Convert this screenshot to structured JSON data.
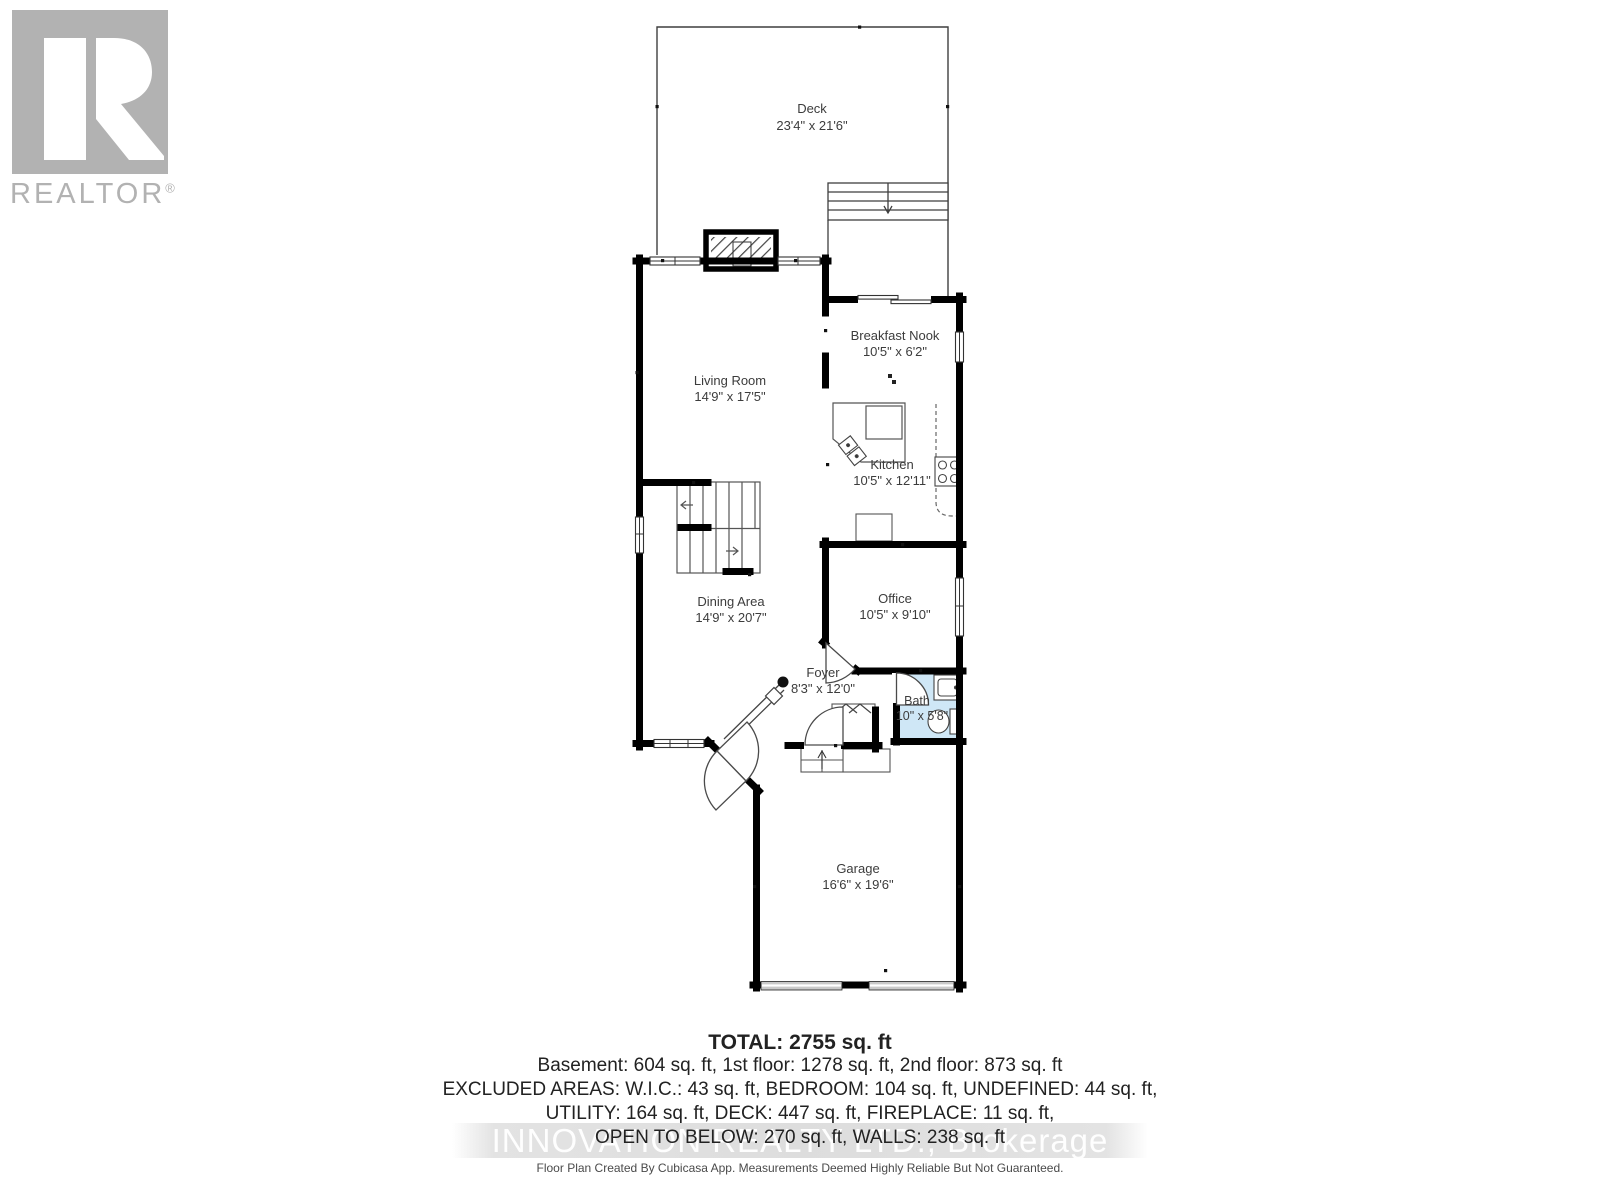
{
  "branding": {
    "logo_text": "REALTOR",
    "logo_reg": "®"
  },
  "floorplan": {
    "rooms": [
      {
        "name": "Deck",
        "dims": "23'4\" x 21'6\""
      },
      {
        "name": "Living Room",
        "dims": "14'9\" x 17'5\""
      },
      {
        "name": "Breakfast Nook",
        "dims": "10'5\" x 6'2\""
      },
      {
        "name": "Kitchen",
        "dims": "10'5\" x 12'11\""
      },
      {
        "name": "Dining Area",
        "dims": "14'9\" x 20'7\""
      },
      {
        "name": "Office",
        "dims": "10'5\" x 9'10\""
      },
      {
        "name": "Foyer",
        "dims": "8'3\" x 12'0\""
      },
      {
        "name": "Bath",
        "dims": "10\" x 5'8\""
      },
      {
        "name": "Garage",
        "dims": "16'6\" x 19'6\""
      }
    ]
  },
  "summary": {
    "total": "TOTAL: 2755 sq. ft",
    "line1": "Basement: 604 sq. ft, 1st floor: 1278 sq. ft, 2nd floor: 873 sq. ft",
    "line2": "EXCLUDED AREAS: W.I.C.: 43 sq. ft, BEDROOM: 104 sq. ft, UNDEFINED: 44 sq. ft,",
    "line3": "UTILITY: 164 sq. ft, DECK: 447 sq. ft, FIREPLACE: 11 sq. ft,",
    "line4": "OPEN TO BELOW: 270 sq. ft, WALLS: 238 sq. ft"
  },
  "watermark": "INNOVATION REALTY LTD., Brokerage",
  "footer": "Floor Plan Created By Cubicasa App. Measurements Deemed Highly Reliable But Not Guaranteed.",
  "colors": {
    "wall": "#000000",
    "bath_fill": "#cfe7f6",
    "logo_gray": "#b2b2b2",
    "label_text": "#3c3c3c",
    "watermark_band": "#dddddd",
    "garage_door": "#c9c9c9"
  }
}
